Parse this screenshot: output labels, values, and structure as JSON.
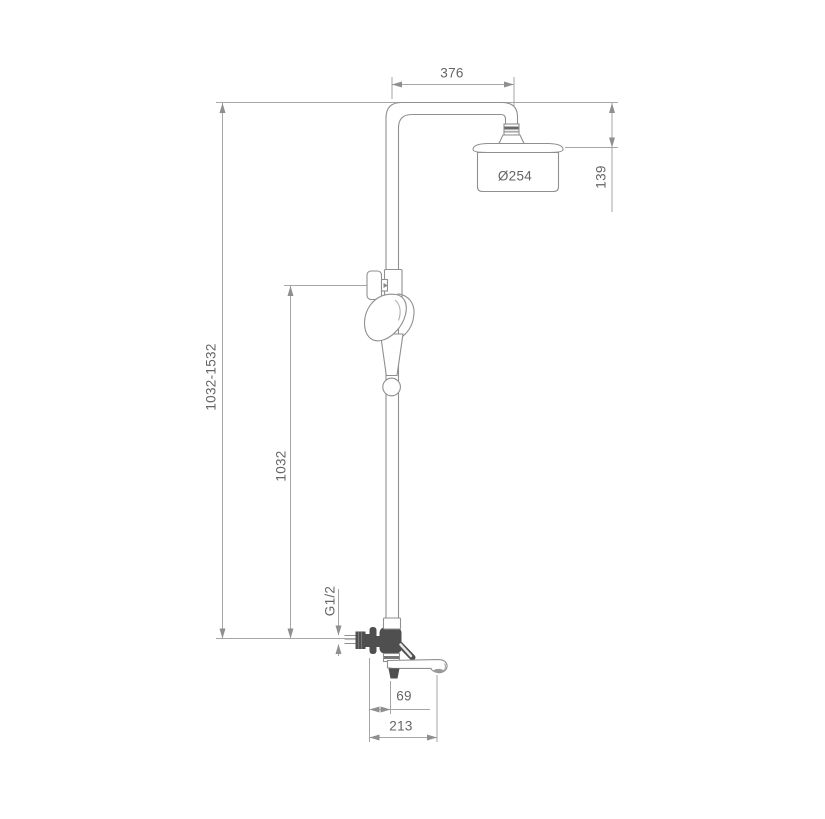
{
  "drawing": {
    "type": "shower-system-installation-dimension-drawing",
    "units": "mm"
  },
  "colors": {
    "background": "#ffffff",
    "outline_gray": "#8f8f8f",
    "dimension_gray": "#a6a6a6",
    "dark_fill": "#4f4f4f",
    "text_gray": "#656565"
  },
  "dimensions": {
    "top_width": "376",
    "head_diameter": "Ø254",
    "head_drop": "139",
    "height_range": "1032-1532",
    "pipe_height": "1032",
    "inlet_thread": "G1/2",
    "spout_offset": "69",
    "spout_reach": "213"
  }
}
